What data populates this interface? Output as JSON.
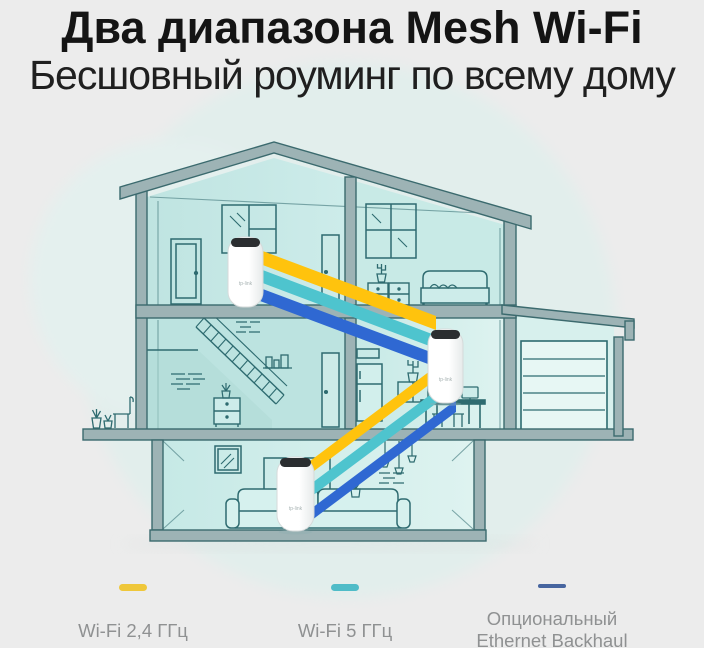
{
  "title": "Два диапазона Mesh Wi-Fi",
  "subtitle": "Бесшовный роуминг по всему дому",
  "device_logo": "tp-link",
  "legend": {
    "items": [
      {
        "label": "Wi-Fi 2,4 ГГц",
        "color": "#EFC73A",
        "dash_css": "background:#EFC73A"
      },
      {
        "label": "Wi-Fi 5 ГГц",
        "color": "#4FBCC8",
        "dash_css": "background:#4FBCC8"
      },
      {
        "label_line1": "Опциональный",
        "label_line2": "Ethernet Backhaul",
        "color": "#47659F",
        "dash_css": "background:#47659F;height:4px;margin-bottom:3px"
      }
    ]
  },
  "illustration": {
    "beam_colors": {
      "wifi_2_4": "#FFC30D",
      "wifi_5": "#4EC4CE",
      "ethernet": "#2F68D2"
    },
    "device_count_note": "3"
  }
}
